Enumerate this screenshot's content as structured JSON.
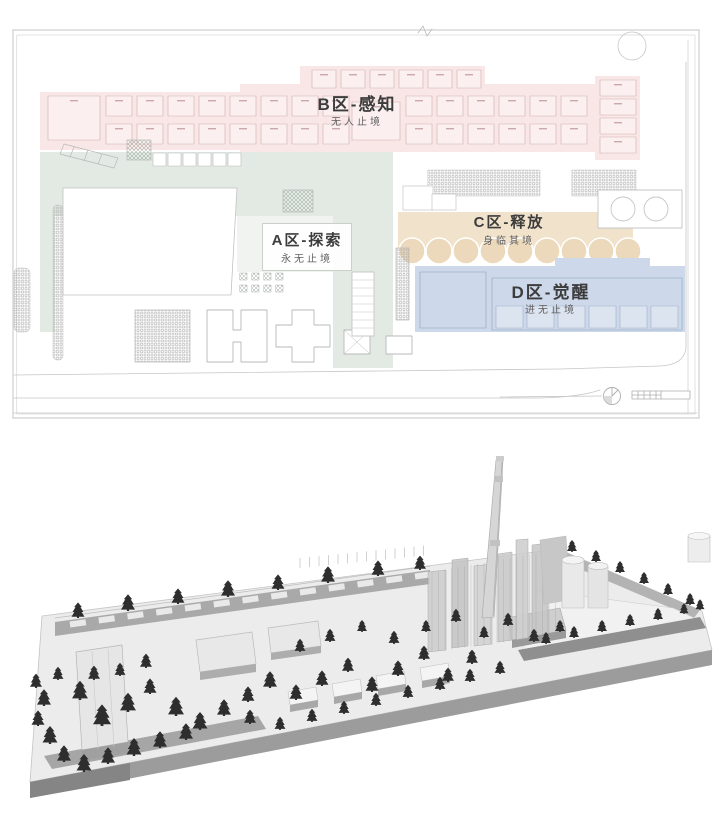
{
  "plan": {
    "zones": {
      "b": {
        "label": "B区-感知",
        "subtitle": "无人止境"
      },
      "a": {
        "label": "A区-探索",
        "subtitle": "永无止境"
      },
      "c": {
        "label": "C区-释放",
        "subtitle": "身临其境"
      },
      "d": {
        "label": "D区-觉醒",
        "subtitle": "进无止境"
      }
    },
    "icons": {
      "north": "compass-icon",
      "scale": "scale-bar-icon"
    }
  },
  "colors": {
    "zone_b": "#f8e7e6",
    "zone_a": "#e3eae4",
    "zone_c": "#f1e2cb",
    "zone_c_circle": "#ecd8ba",
    "zone_d": "#cdd9ea",
    "plan_line": "#c6c6c6",
    "plan_detail": "#b9b9b9",
    "label_text": "#3c3c3c",
    "subtitle_text": "#5f5f5f",
    "axon_platform": "#ececec",
    "axon_skirt": "#9c9c9c",
    "axon_band": "#a9a9a9",
    "axon_wall": "#8f8f8f",
    "axon_tree": "#2e2e2e",
    "axon_building": "#e6e6e6",
    "axon_glass": "#c9c9c9",
    "axon_stroke": "#a8a8a8"
  }
}
